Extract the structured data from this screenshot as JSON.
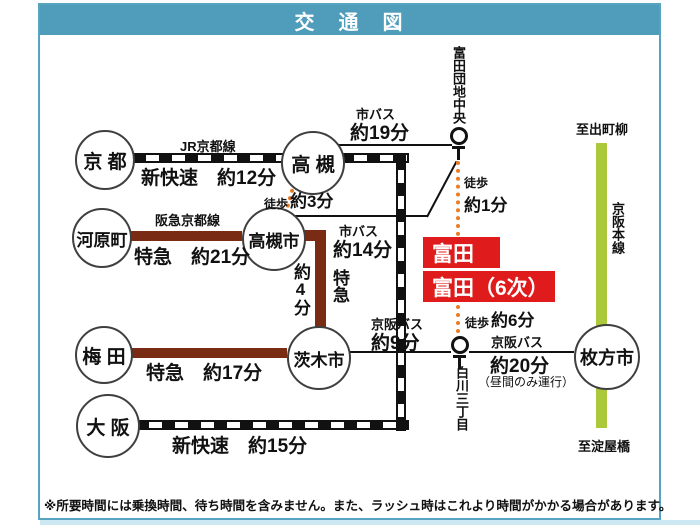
{
  "title": "交　通　図",
  "footer": "※所要時間には乗換時間、待ち時間を含みません。また、ラッシュ時はこれより時間がかかる場合があります。",
  "colors": {
    "header_teal": "#4f9dba",
    "frame_border": "#58a3c0",
    "jr_line_black": "#111111",
    "hankyu_maroon": "#7a2b13",
    "highlight_red": "#e01b1b",
    "walk_orange": "#e87d28",
    "keihan_green": "#abc93a",
    "bottom_strip": "#cde8f2"
  },
  "stations": {
    "kyoto": "京 都",
    "takatsuki": "高 槻",
    "kawaramachi": "河原町",
    "takatsuki_shi": "高槻市",
    "umeda": "梅 田",
    "ibaraki_shi": "茨木市",
    "osaka": "大 阪",
    "hirakata_shi": "枚方市"
  },
  "bus_stops": {
    "tomita_danchi_chuo": "富田団地中央",
    "shirakawa_sanchome": "白川三丁目"
  },
  "destination": {
    "name": "富田",
    "name2": "富田（6次）"
  },
  "lines": {
    "jr_kyoto": {
      "name": "JR京都線",
      "time": "新快速　約12分"
    },
    "jr_osaka": {
      "time": "新快速　約15分"
    },
    "hankyu_kyoto": {
      "name": "阪急京都線",
      "time": "特急　約21分"
    },
    "hankyu_mid": {
      "time_vertical": "約4分",
      "type_vertical": "特急"
    },
    "hankyu_umeda": {
      "time": "特急　約17分"
    },
    "city_bus_takatsuki": {
      "name": "市バス",
      "time": "約19分"
    },
    "city_bus_takatsuki_shi": {
      "name": "市バス",
      "time": "約14分"
    },
    "keihan_bus_ibaraki": {
      "name": "京阪バス",
      "time": "約9分"
    },
    "keihan_bus_hirakata": {
      "name": "京阪バス",
      "time": "約20分",
      "note": "（昼間のみ運行）"
    },
    "keihan_main": {
      "name": "京阪本線",
      "to_north": "至出町柳",
      "to_south": "至淀屋橋"
    },
    "walk_takatsuki": {
      "name": "徒歩",
      "time": "約3分"
    },
    "walk_tomita_north": {
      "name": "徒歩",
      "time": "約1分"
    },
    "walk_tomita_south": {
      "name": "徒歩",
      "time": "約6分"
    }
  }
}
